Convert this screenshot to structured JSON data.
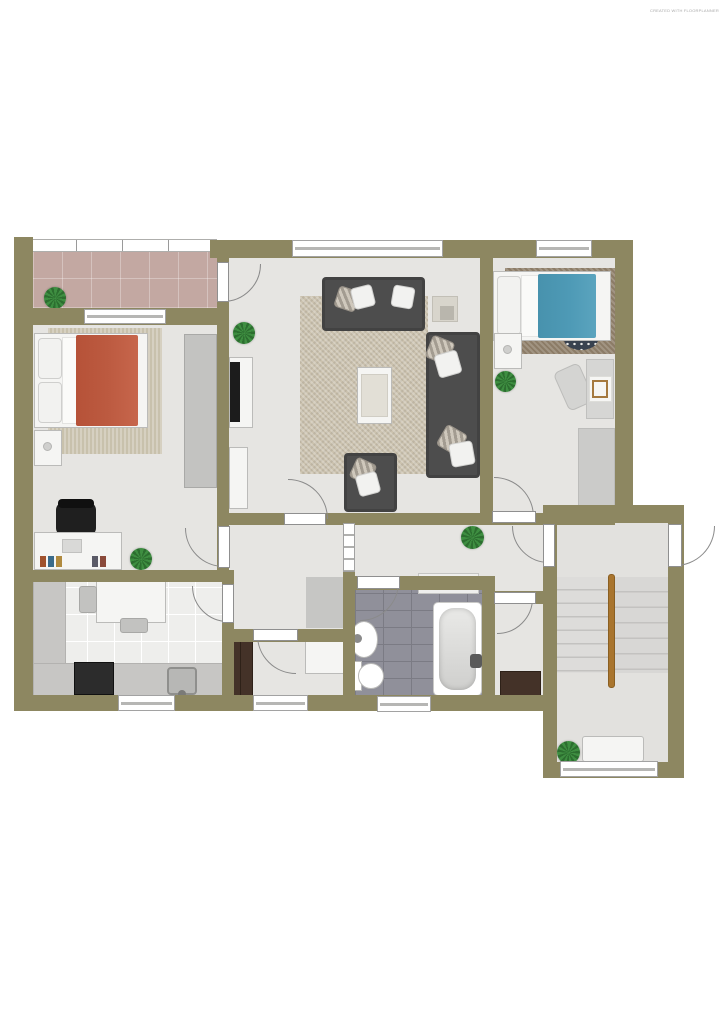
{
  "watermark": {
    "text": "CREATED WITH FLOORPLANNER"
  },
  "palette": {
    "wall": "#8d8761",
    "floor": "#e6e5e2",
    "stairfloor": "#e2e1de",
    "balconyfloor": "#c3a8a2",
    "bathtile": "#90909a",
    "bathgrout": "#7b7b84",
    "kitchentile": "#eeeeec",
    "rugliving": "#cbc2ae",
    "rugbeige": "#c8c1ac",
    "rugbrown": "#8c7c67",
    "ruggray": "#cbcbc9",
    "mat": "#c6c6c4",
    "sofa": "#4d4d4d",
    "red": "#bc5a40",
    "blue": "#4e9ab6",
    "whitefurn": "#f5f5f3",
    "furnline": "#bbbbb9",
    "darkwood": "#443228",
    "counter": "#c7c6c4",
    "stove": "#2c2c2c",
    "plantA": "#3e8e41",
    "plantB": "#2c6e2f",
    "handrail": "#a9752e",
    "step": "#dddcda",
    "stepline": "#c3c2c0",
    "arcline": "#8a8a8a",
    "frameline": "#8f8f8f",
    "winline": "#b0b0ae",
    "tv": "#1c1c1c",
    "wmcolor": "#a9a9a9",
    "wardrobe": "#c3c3c1",
    "pouf": "#39424f",
    "chairwood": "#a5793f"
  },
  "rooms": [
    {
      "name": "balcony",
      "features": [
        "tiled-floor",
        "railing",
        "plant"
      ]
    },
    {
      "name": "bedroom-1",
      "features": [
        "double-bed-red-blanket",
        "area-rug",
        "nightstand",
        "wardrobe",
        "desk",
        "office-chair",
        "books",
        "plant"
      ]
    },
    {
      "name": "living-room",
      "features": [
        "sofa",
        "corner-sofa",
        "armchair",
        "coffee-table",
        "side-table",
        "tv-sideboard",
        "cabinet",
        "large-rug",
        "plant",
        "balcony-door"
      ]
    },
    {
      "name": "bedroom-2",
      "features": [
        "single-bed-blue-blanket",
        "brown-rug",
        "dotted-pouf",
        "nightstand",
        "desk",
        "chair",
        "gray-rug",
        "plant"
      ]
    },
    {
      "name": "kitchen",
      "features": [
        "l-shaped-counter",
        "stove",
        "sink",
        "dining-table",
        "two-chairs",
        "window"
      ]
    },
    {
      "name": "vestibule",
      "features": [
        "doormat",
        "glazed-partition"
      ]
    },
    {
      "name": "hallway",
      "features": [
        "sideboard",
        "plant"
      ]
    },
    {
      "name": "storage-room",
      "features": [
        "dark-wardrobe",
        "white-dresser",
        "window"
      ]
    },
    {
      "name": "bathroom",
      "features": [
        "bathtub",
        "wash-basin",
        "toilet",
        "gray-tile-floor",
        "window"
      ]
    },
    {
      "name": "wc-room",
      "features": [
        "dark-dresser"
      ]
    },
    {
      "name": "stairwell",
      "features": [
        "u-shaped-stairs",
        "wood-handrail",
        "bench",
        "plant",
        "entry-door",
        "window"
      ]
    }
  ]
}
